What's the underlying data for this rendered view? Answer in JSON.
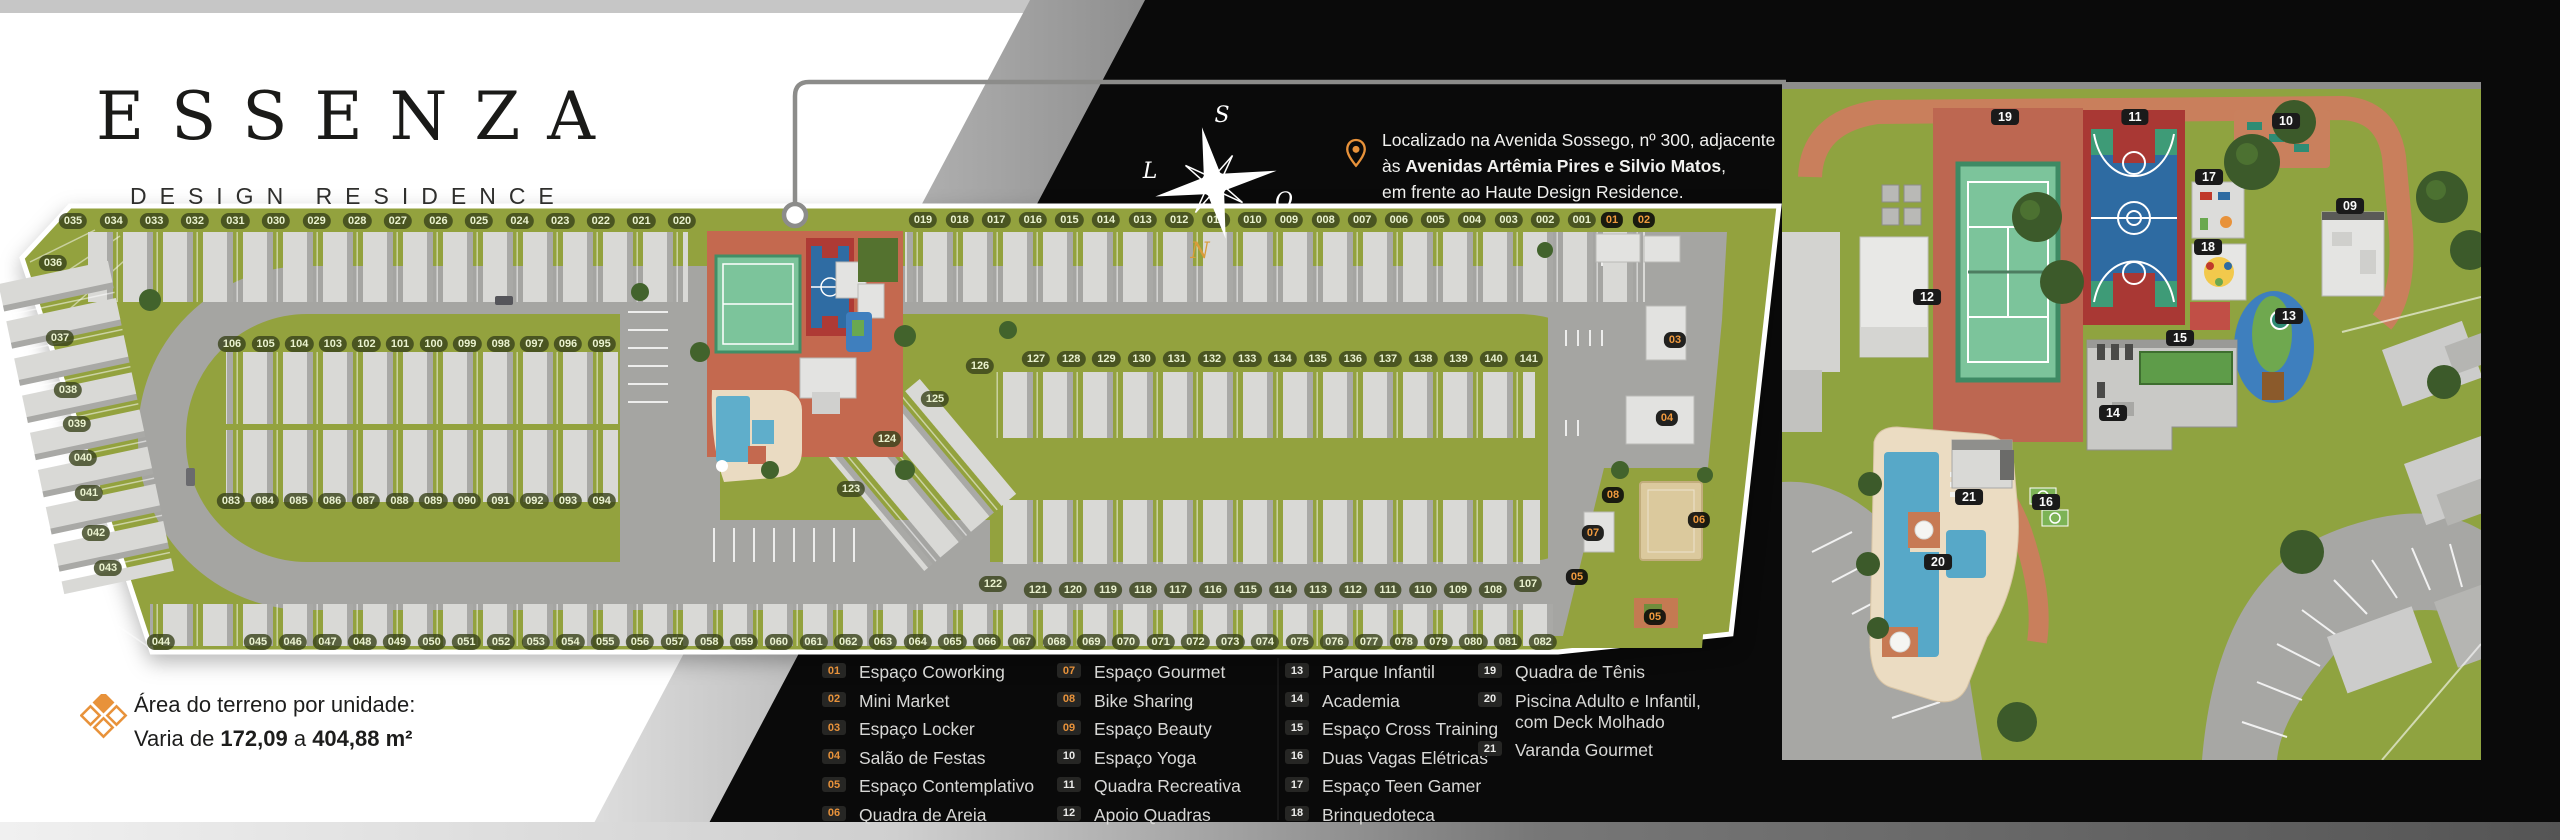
{
  "brand": {
    "name": "ESSENZA",
    "subtitle": "DESIGN RESIDENCE"
  },
  "location": {
    "line1": "Localizado na Avenida Sossego, nº 300, adjacente",
    "line2_prefix": "às ",
    "line2_bold": "Avenidas Artêmia Pires e Silvio Matos",
    "line2_suffix": ",",
    "line3": "em frente ao Haute Design Residence."
  },
  "compass": {
    "top": "S",
    "left": "L",
    "right": "O",
    "bottom": "N"
  },
  "area_info": {
    "title": "Área do terreno por unidade:",
    "prefix": "Varia de ",
    "min": "172,09",
    "mid": " a ",
    "max": "404,88 m²"
  },
  "colors": {
    "accent_orange": "#e8923a",
    "plan_green": "#93a23e",
    "panel_black": "#0a0a0a"
  },
  "legend": {
    "columns": [
      [
        {
          "num": "01",
          "label": "Espaço Coworking"
        },
        {
          "num": "02",
          "label": "Mini Market"
        },
        {
          "num": "03",
          "label": "Espaço Locker"
        },
        {
          "num": "04",
          "label": "Salão de Festas"
        },
        {
          "num": "05",
          "label": "Espaço Contemplativo"
        },
        {
          "num": "06",
          "label": "Quadra de Areia"
        }
      ],
      [
        {
          "num": "07",
          "label": "Espaço Gourmet"
        },
        {
          "num": "08",
          "label": "Bike Sharing"
        },
        {
          "num": "09",
          "label": "Espaço Beauty"
        },
        {
          "num": "10",
          "label": "Espaço Yoga"
        },
        {
          "num": "11",
          "label": "Quadra Recreativa"
        },
        {
          "num": "12",
          "label": "Apoio Quadras"
        }
      ],
      [
        {
          "num": "13",
          "label": "Parque Infantil"
        },
        {
          "num": "14",
          "label": "Academia"
        },
        {
          "num": "15",
          "label": "Espaço Cross Training"
        },
        {
          "num": "16",
          "label": "Duas Vagas Elétricas"
        },
        {
          "num": "17",
          "label": "Espaço Teen Gamer"
        },
        {
          "num": "18",
          "label": "Brinquedoteca"
        }
      ],
      [
        {
          "num": "19",
          "label": "Quadra de Tênis"
        },
        {
          "num": "20",
          "label": "Piscina Adulto e Infantil,",
          "label2": "com Deck Molhado"
        },
        {
          "num": "21",
          "label": "Varanda Gourmet"
        }
      ]
    ]
  },
  "site_plan": {
    "lots": {
      "top_row_a": [
        "035",
        "034",
        "033",
        "032",
        "031",
        "030",
        "029",
        "028",
        "027",
        "026",
        "025",
        "024",
        "023",
        "022",
        "021",
        "020"
      ],
      "top_row_b": [
        "019",
        "018",
        "017",
        "016",
        "015",
        "014",
        "013",
        "012",
        "011",
        "010",
        "009",
        "008",
        "007",
        "006",
        "005",
        "004",
        "003",
        "002",
        "001"
      ],
      "club_row": [
        "01",
        "02"
      ],
      "left_col": [
        "036",
        "037",
        "038",
        "039",
        "040",
        "041",
        "042",
        "043"
      ],
      "mid_top": [
        "106",
        "105",
        "104",
        "103",
        "102",
        "101",
        "100",
        "099",
        "098",
        "097",
        "096",
        "095"
      ],
      "mid_bottom": [
        "083",
        "084",
        "085",
        "086",
        "087",
        "088",
        "089",
        "090",
        "091",
        "092",
        "093",
        "094"
      ],
      "right_diag": [
        "126",
        "125",
        "124",
        "123"
      ],
      "right_top": [
        "127",
        "128",
        "129",
        "130",
        "131",
        "132",
        "133",
        "134",
        "135",
        "136",
        "137",
        "138",
        "139",
        "140",
        "141"
      ],
      "right_bottom_ends": [
        "122",
        "107"
      ],
      "right_bottom": [
        "121",
        "120",
        "119",
        "118",
        "117",
        "116",
        "115",
        "114",
        "113",
        "112",
        "111",
        "110",
        "109",
        "108"
      ],
      "bottom_a": [
        "044"
      ],
      "bottom_b": [
        "045",
        "046",
        "047",
        "048",
        "049",
        "050",
        "051",
        "052",
        "053",
        "054",
        "055",
        "056",
        "057",
        "058",
        "059",
        "060",
        "061",
        "062",
        "063",
        "064",
        "065",
        "066",
        "067",
        "068",
        "069",
        "070",
        "071",
        "072",
        "073",
        "074",
        "075",
        "076",
        "077",
        "078",
        "079",
        "080",
        "081",
        "082"
      ]
    },
    "amenity_markers": [
      {
        "n": "03",
        "x": 1675,
        "y": 340
      },
      {
        "n": "04",
        "x": 1667,
        "y": 418
      },
      {
        "n": "08",
        "x": 1613,
        "y": 495
      },
      {
        "n": "06",
        "x": 1699,
        "y": 520
      },
      {
        "n": "07",
        "x": 1593,
        "y": 533
      },
      {
        "n": "05",
        "x": 1577,
        "y": 577
      },
      {
        "n": "05",
        "x": 1655,
        "y": 617
      }
    ]
  },
  "detail_plan": {
    "markers": [
      {
        "n": "19",
        "x": 223,
        "y": 35
      },
      {
        "n": "11",
        "x": 353,
        "y": 35
      },
      {
        "n": "10",
        "x": 504,
        "y": 39
      },
      {
        "n": "17",
        "x": 427,
        "y": 95
      },
      {
        "n": "09",
        "x": 568,
        "y": 124
      },
      {
        "n": "18",
        "x": 426,
        "y": 165
      },
      {
        "n": "12",
        "x": 145,
        "y": 215
      },
      {
        "n": "13",
        "x": 507,
        "y": 234
      },
      {
        "n": "15",
        "x": 398,
        "y": 256
      },
      {
        "n": "14",
        "x": 331,
        "y": 331
      },
      {
        "n": "21",
        "x": 187,
        "y": 415
      },
      {
        "n": "16",
        "x": 264,
        "y": 420
      },
      {
        "n": "20",
        "x": 156,
        "y": 480
      }
    ]
  }
}
